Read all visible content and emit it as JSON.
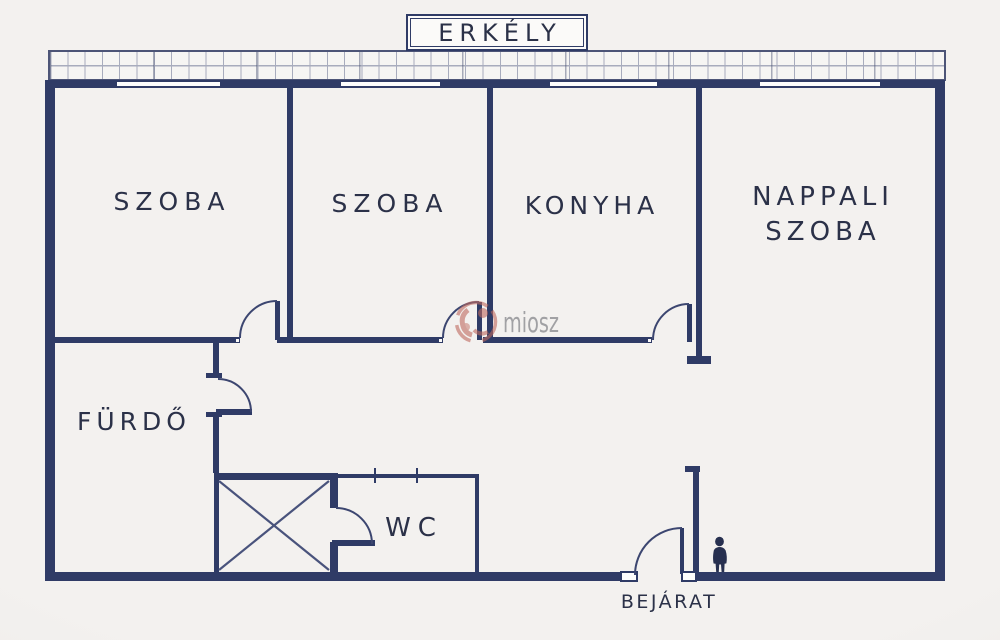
{
  "balcony": {
    "label": "ERKÉLY"
  },
  "rooms": {
    "room1": {
      "label": "SZOBA"
    },
    "room2": {
      "label": "SZOBA"
    },
    "kitchen": {
      "label": "KONYHA"
    },
    "living": {
      "line1": "NAPPALI",
      "line2": "SZOBA"
    },
    "bathroom": {
      "label": "FÜRDŐ"
    },
    "wc": {
      "label": "WC"
    }
  },
  "entrance": {
    "label": "BEJÁRAT"
  },
  "watermark": {
    "text": "miosz"
  },
  "colors": {
    "wall": "#2f3b66",
    "line": "#3c4670",
    "text": "#2b3148",
    "bg": "#f3f1ef",
    "bg_edge": "#e8e4e1",
    "grid": "#a8acbd",
    "wm_red": "#bf6a5f",
    "wm_gray": "#8d8e92"
  }
}
